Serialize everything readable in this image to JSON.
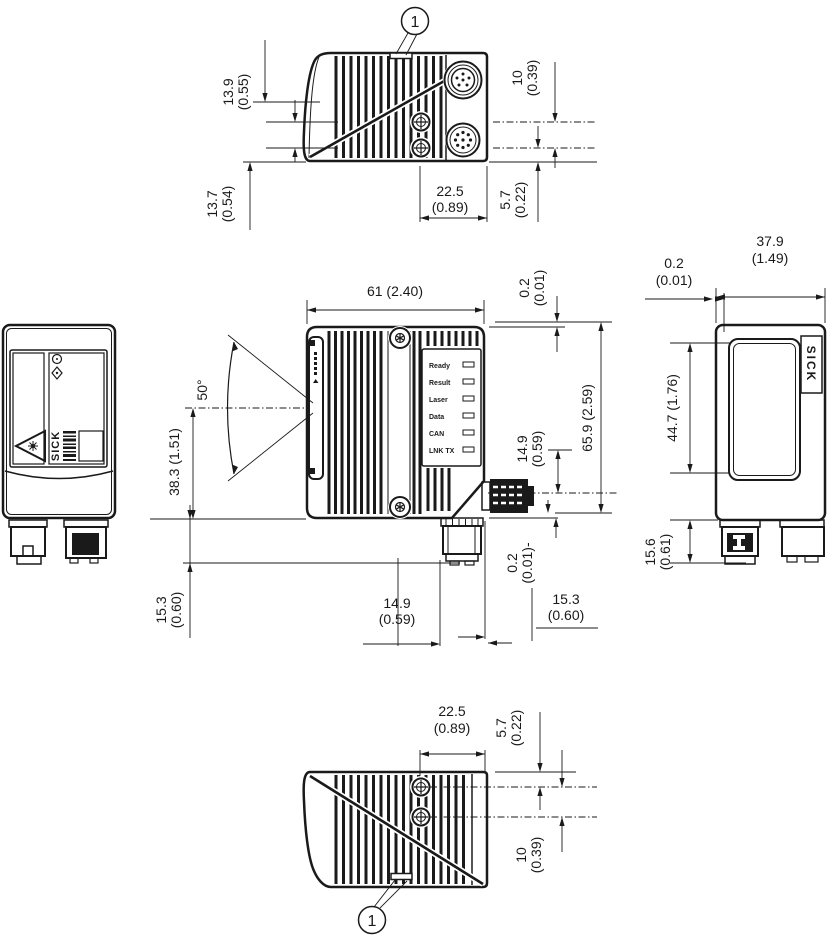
{
  "drawing": {
    "callout_label": "1",
    "brand": "SICK",
    "leds": [
      "Ready",
      "Result",
      "Laser",
      "Data",
      "CAN",
      "LNK TX"
    ],
    "angle": "50°",
    "dims": {
      "d13_9": {
        "mm": "13.9",
        "in": "(0.55)"
      },
      "d13_7": {
        "mm": "13.7",
        "in": "(0.54)"
      },
      "d10_top": {
        "mm": "10",
        "in": "(0.39)"
      },
      "d5_7_top": {
        "mm": "5.7",
        "in": "(0.22)"
      },
      "d22_5_top": {
        "mm": "22.5",
        "in": "(0.89)"
      },
      "d61": {
        "text": "61 (2.40)"
      },
      "d0_2_front_top": {
        "mm": "0.2",
        "in": "(0.01)"
      },
      "d65_9": {
        "text": "65.9 (2.59)"
      },
      "d14_9_right": {
        "mm": "14.9",
        "in": "(0.59)"
      },
      "d38_3": {
        "text": "38.3 (1.51)"
      },
      "d15_3_left": {
        "mm": "15.3",
        "in": "(0.60)"
      },
      "d0_2_front_bottom": {
        "mm": "0.2",
        "in": "(0.01)-"
      },
      "d14_9_bottom": {
        "mm": "14.9",
        "in": "(0.59)"
      },
      "d15_3_bottom": {
        "mm": "15.3",
        "in": "(0.60)"
      },
      "d37_9": {
        "mm": "37.9",
        "in": "(1.49)"
      },
      "d0_2_right": {
        "mm": "0.2",
        "in": "(0.01)"
      },
      "d44_7": {
        "text": "44.7 (1.76)"
      },
      "d15_6": {
        "mm": "15.6",
        "in": "(0.61)"
      },
      "d22_5_bottom": {
        "mm": "22.5",
        "in": "(0.89)"
      },
      "d5_7_bottom": {
        "mm": "5.7",
        "in": "(0.22)"
      },
      "d10_bottom": {
        "mm": "10",
        "in": "(0.39)"
      }
    }
  }
}
